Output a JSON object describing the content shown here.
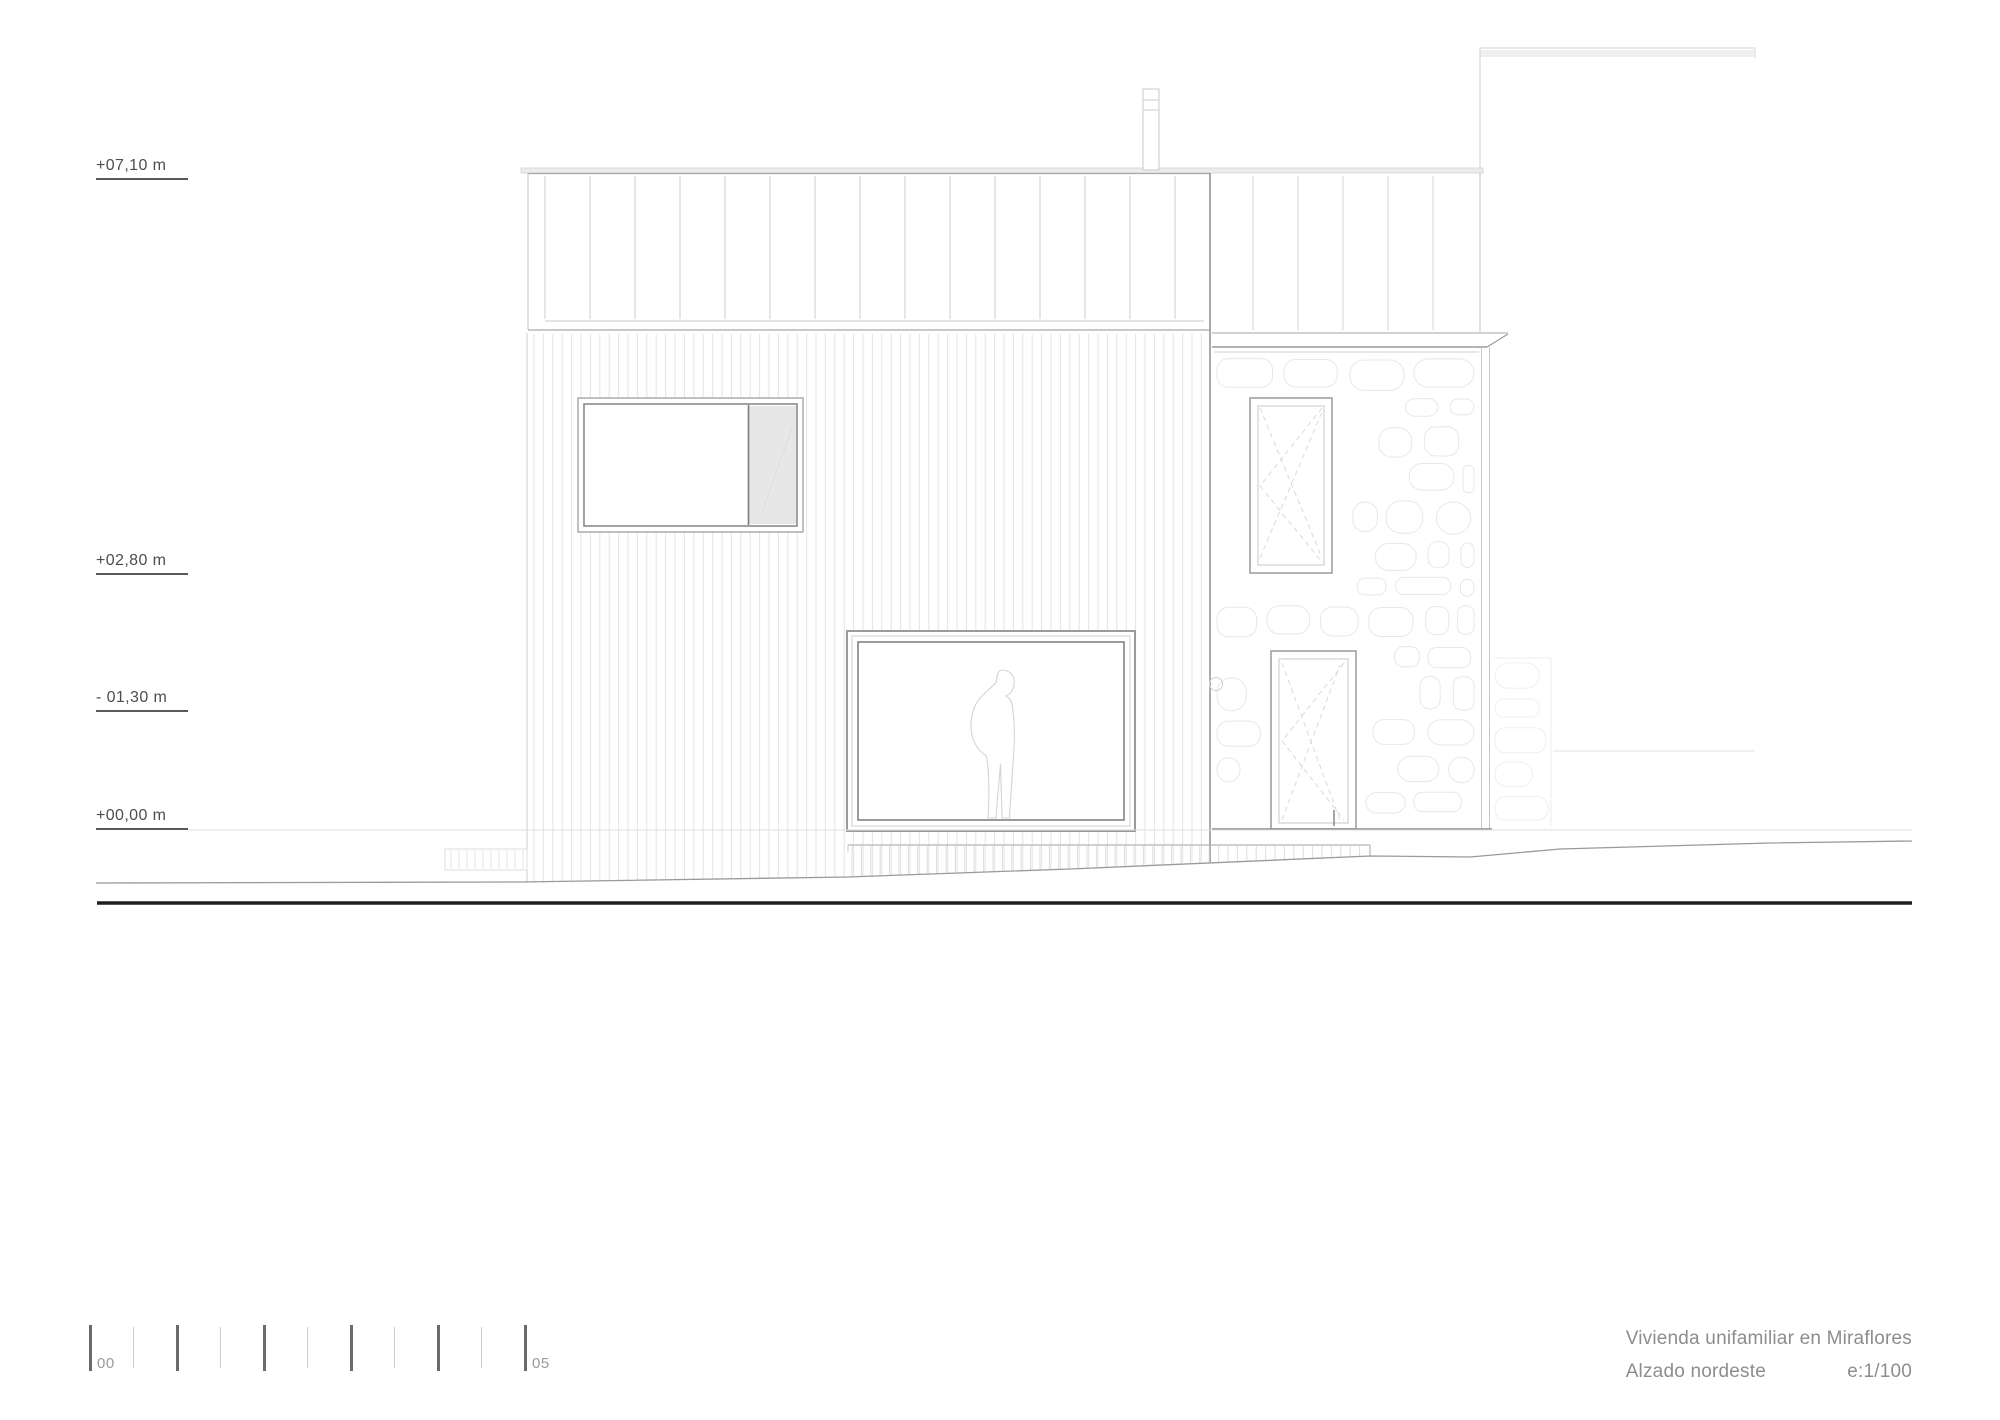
{
  "title_block": {
    "project": "Vivienda unifamiliar en Miraflores",
    "drawing": "Alzado nordeste",
    "scale": "e:1/100",
    "text_color": "#8d8d8d"
  },
  "levels": [
    {
      "label": "+07,10 m",
      "y": 180
    },
    {
      "label": "+02,80 m",
      "y": 575
    },
    {
      "label": "- 01,30 m",
      "y": 712
    },
    {
      "label": "+00,00 m",
      "y": 830
    }
  ],
  "scale_bar": {
    "start_label": "00",
    "end_label": "05",
    "tick_count": 11,
    "tick_spacing_px": 43.5
  },
  "drawing_colors": {
    "section_line": "#1f1f1f",
    "dark_line": "#8e8e8e",
    "medium_line": "#b0b0b0",
    "light_line": "#d4d4d4",
    "stone_line": "#e8e8e8",
    "panel_fill": "#e7e7e7"
  }
}
